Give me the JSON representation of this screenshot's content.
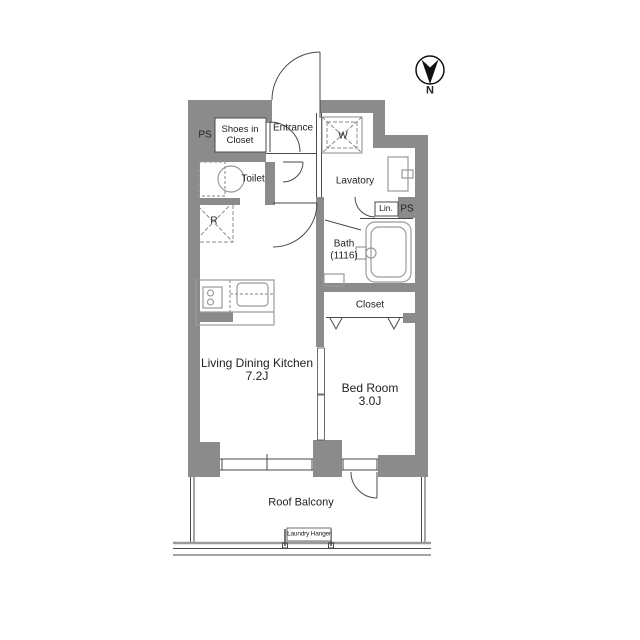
{
  "title": "apartment-floor-plan",
  "colors": {
    "wall": "#8b8b8b",
    "line": "#4a4a4a",
    "fixture": "#9a9a9a",
    "dash": "#8a8a8a",
    "ink": "#111111",
    "paper": "#ffffff"
  },
  "compass": {
    "north_label": "N"
  },
  "rooms": {
    "ps_left": "PS",
    "shoes_closet_line1": "Shoes in",
    "shoes_closet_line2": "Closet",
    "entrance": "Entrance",
    "washer": "W",
    "toilet": "Toilet",
    "lavatory": "Lavatory",
    "linen": "Lin.",
    "ps_right": "PS",
    "bath_line1": "Bath",
    "bath_line2": "(1116)",
    "refrigerator": "R",
    "closet": "Closet",
    "ldk_line1": "Living Dining Kitchen",
    "ldk_line2": "7.2J",
    "bedroom_line1": "Bed Room",
    "bedroom_line2": "3.0J",
    "balcony": "Roof Balcony",
    "laundry_hanger": "Laundry Hanger"
  }
}
